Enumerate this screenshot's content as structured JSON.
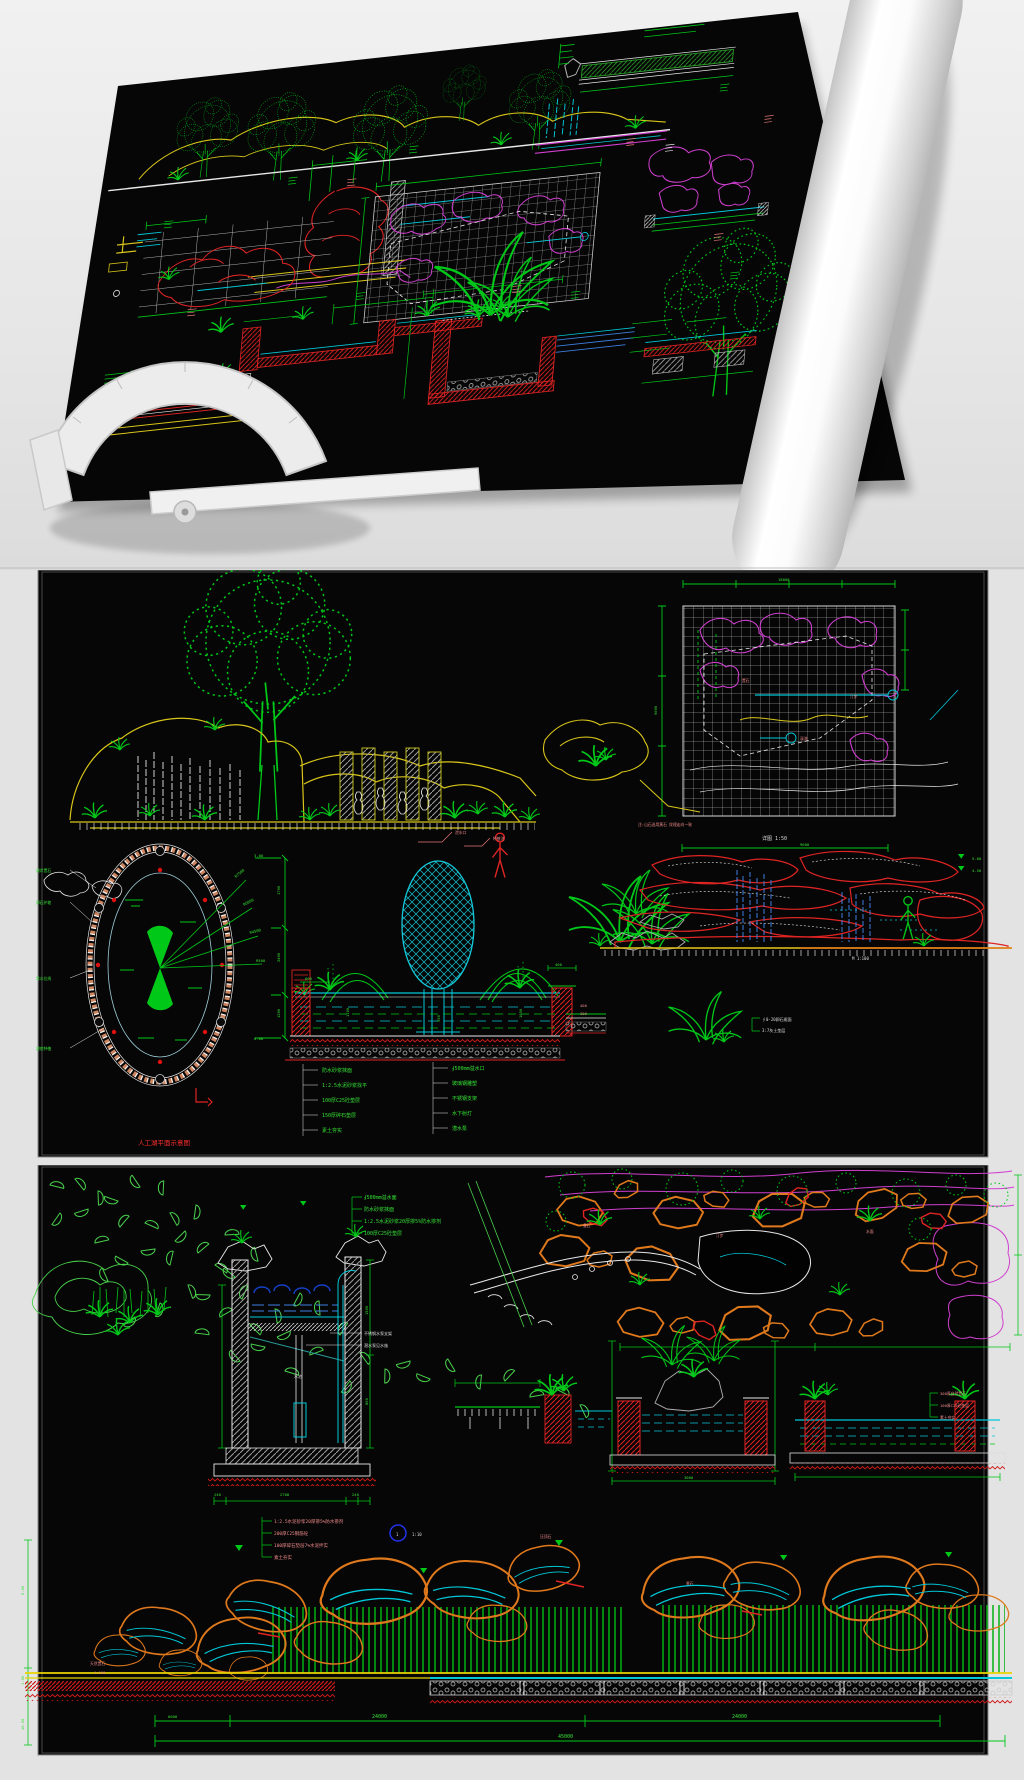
{
  "page": {
    "bg": "#e8e8e8",
    "sheet_bg": "#060606"
  },
  "colors": {
    "green": "#00c818",
    "yellow": "#d8c51a",
    "cyan": "#00c8d8",
    "magenta": "#cf3fcf",
    "red": "#e02424",
    "orange": "#e0791c",
    "pink_note": "#ef8a8a",
    "blue": "#3e7fe0",
    "white": "#e8e8e8"
  },
  "panel1": {
    "description": "rolled CAD landscape construction drawing in perspective with drafting protractor"
  },
  "panel2": {
    "plan_dims": {
      "width": "18000",
      "height": "9000"
    },
    "plan_labels": [
      "置石",
      "溪流",
      "汀步"
    ],
    "plan_note": "注:山石选用黄石 纹理走向一致",
    "detail_title": "详图 1:50",
    "elev_width": "9600",
    "elev_levels": [
      "5.00",
      "4.50"
    ],
    "elev_scale": "M 1:100",
    "pond_labels": [
      "湖岸置石",
      "卵石护坡",
      "常水位线",
      "湖底种植"
    ],
    "pond_radial_dims": [
      "R7500",
      "R6000",
      "R4500",
      "R500"
    ],
    "pond_plan_label": "人工湖平面示意图",
    "fount_dims_left": [
      "3.00",
      "1700",
      "2400",
      "1200",
      "0.00"
    ],
    "fount_dims_small": [
      "600",
      "400",
      "1100",
      "950",
      "1050"
    ],
    "fount_leader_labels": [
      "泄水口",
      "种植池"
    ],
    "fount_notes_left": [
      "防水砂浆抹面",
      "1:2.5水泥砂浆找平",
      "100厚C25砼垫层",
      "150厚碎石垫层",
      "素土夯实"
    ],
    "fount_notes_right": [
      "∮500mm溢水口",
      "玻璃钢雕塑",
      "不锈钢支架",
      "水下射灯",
      "潜水泵"
    ],
    "right_notes": [
      "∮0-20卵石缀面",
      "3:7灰土垫层"
    ],
    "edge_dims": [
      "400",
      "300"
    ]
  },
  "panel3": {
    "tank_notes": [
      "∮500mm溢水面",
      "防水砂浆抹面",
      "1:2.5水泥砂浆20厚掺5%防水掺剂",
      "100厚C25砼垫层"
    ],
    "pump_notes": [
      "不锈钢水泵支架",
      "潜水泵见水施"
    ],
    "tank_label": "水池",
    "foundation_notes": [
      "1:2.5水泥砂浆20厚掺5%防水掺剂",
      "200厚C25钢筋砼",
      "100厚碎石垫层7%水泥拌实",
      "素土夯实"
    ],
    "tank_dims": {
      "bottom": [
        "240",
        "2700",
        "240"
      ],
      "right": [
        "1500",
        "800"
      ]
    },
    "detail_marker": {
      "num": "1",
      "scale": "1:10"
    },
    "plan_labels": [
      "叠石",
      "汀步",
      "水面"
    ],
    "section_dim": "3000",
    "section_notes": [
      "300厚自然置石",
      "100厚C25砼垫层",
      "素土夯实"
    ],
    "elev_labels": {
      "name": "天然置石",
      "scale": "1:100"
    },
    "elev_levels": [
      "5.00",
      "1.50",
      "±0.00"
    ],
    "elev_top_labels": [
      "压顶石",
      "景石"
    ],
    "elev_dims": {
      "segments": [
        "24000",
        "24000"
      ],
      "lead": "6000",
      "total": "45000"
    }
  }
}
